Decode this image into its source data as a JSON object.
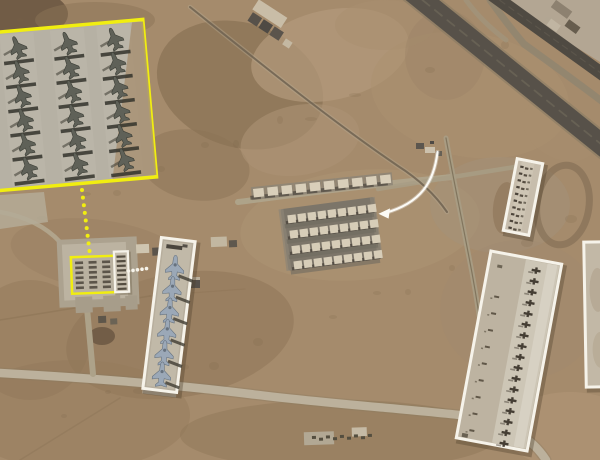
{
  "image": {
    "kind": "annotated satellite photo",
    "subject": "desert airbase with highlighted aircraft parking areas",
    "width": 600,
    "height": 460
  },
  "colors": {
    "annotation_yellow": "#f1ee10",
    "annotation_white": "#f6f3ea",
    "arrow_white": "#fcfbf6",
    "sand_base": "#a58b6c",
    "sand_light": "#b49a7c",
    "sand_dark": "#8b7355",
    "soil_dark": "#6b5743",
    "concrete_light": "#bcb19c",
    "concrete_pale": "#c9c2b2",
    "apron_gray": "#b6b1a4",
    "runway_dark": "#575149",
    "runway_darker": "#4f4a42",
    "shelter_roof": "#d9cfba",
    "shelter_shadow": "#4b453c",
    "jet_dark": "#5f6158",
    "jet_dark_outline": "#3e4038",
    "jet_light": "#9ba8b7",
    "jet_light_outline": "#66727f",
    "mark_dark": "#4c443a",
    "shadow_dark": "#33322b",
    "box_shadow": "#4a3c28"
  },
  "annotations": {
    "inset_box": {
      "border": "yellow",
      "content": "fighter jets parked in grid",
      "jet_cols": 3,
      "jet_rows": 6
    },
    "site_pad_box": {
      "border": "yellow",
      "content": "small parking pad",
      "cols": 3,
      "rows": 6
    },
    "site_strip_box": {
      "border": "white",
      "content": "narrow parking strip",
      "rows": 8
    },
    "diagonal_box": {
      "border": "white",
      "content": "jets on diagonal taxiway",
      "jet_count": 6
    },
    "north_ramp_box": {
      "border": "white",
      "content": "dense aircraft row",
      "rows": 10,
      "cols": 2
    },
    "east_flightline_box": {
      "border": "white",
      "content": "long aircraft flightline",
      "aircraft_count": 17,
      "secondary_marks": 9
    },
    "east_edge_box": {
      "border": "white",
      "content": "apron clipped at image edge"
    },
    "yellow_dotted_leader": {
      "dots": 9
    },
    "white_dotted_leader": {
      "dots": 5
    },
    "curved_arrow": {
      "color": "white",
      "points_at": "aircraft shelter block"
    }
  },
  "airfield": {
    "runway_count": 2,
    "shelter_top_row_count": 10,
    "shelter_block": {
      "rows": 4,
      "cols": 9
    },
    "compound_marks": 9
  }
}
